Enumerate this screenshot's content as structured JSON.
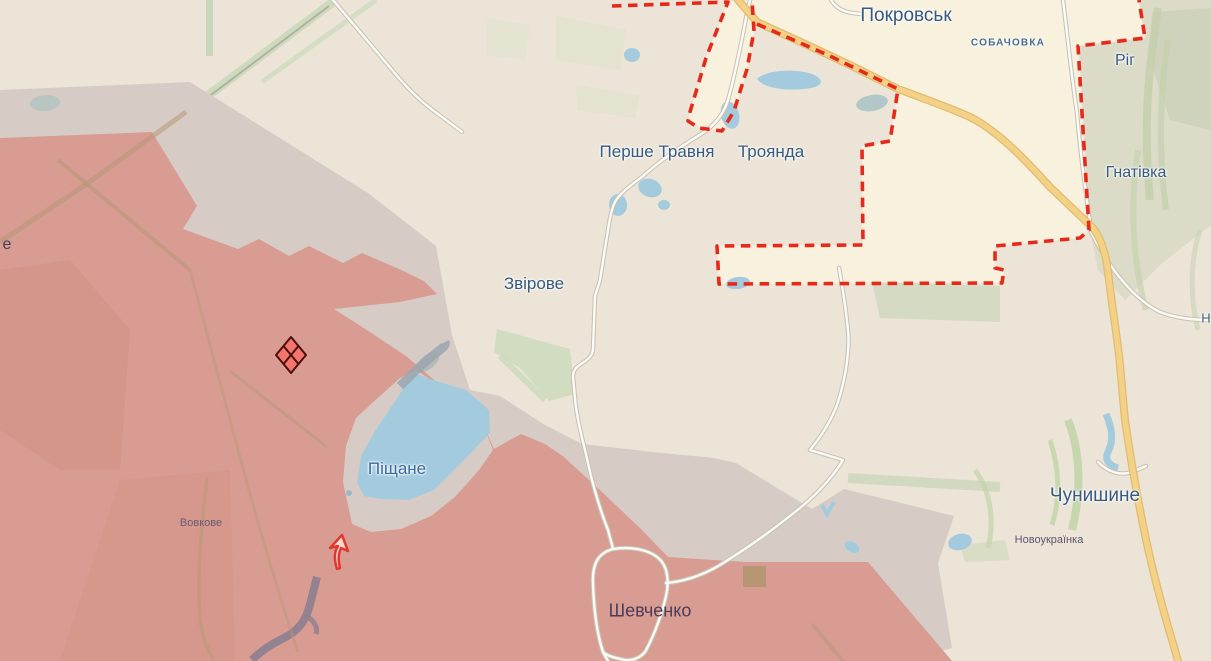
{
  "app": {
    "type": "interactive-frontline-map",
    "language": "uk"
  },
  "map": {
    "labels": {
      "pokrovsk": "Покровськ",
      "sobachovka": "СОБАЧОВКА",
      "rih": "Ріг",
      "hnativka": "Гнатівка",
      "pershe_travnia": "Перше Травня",
      "troianda": "Троянда",
      "zvirove": "Звірове",
      "pishchane": "Піщане",
      "vovkove": "Вовкове",
      "shevchenko": "Шевченко",
      "chunyshyne": "Чунишине",
      "novoukrainka": "Новоукраїнка",
      "edge_left_partial": "е",
      "edge_right_partial": "Н"
    },
    "markers": {
      "fortification_diamond": {
        "shape": "quartered-diamond",
        "fill": "#f4756c",
        "outline": "#4a100d"
      },
      "advance_arrow": {
        "shape": "arrow-up-right",
        "stroke": "#e0372e",
        "fill": "#fadbd4"
      }
    },
    "colors": {
      "background": "#ebe4d7",
      "occupied_zone": "#d99c92",
      "grey_zone": "#d7ccc5",
      "city_area": "#f8f1de",
      "contested_boundary": "#e6291b",
      "water": "#a3cbdd",
      "highway": "#f3d287",
      "vegetation": "#ccd9ba",
      "label_primary": "#375a7e"
    }
  }
}
